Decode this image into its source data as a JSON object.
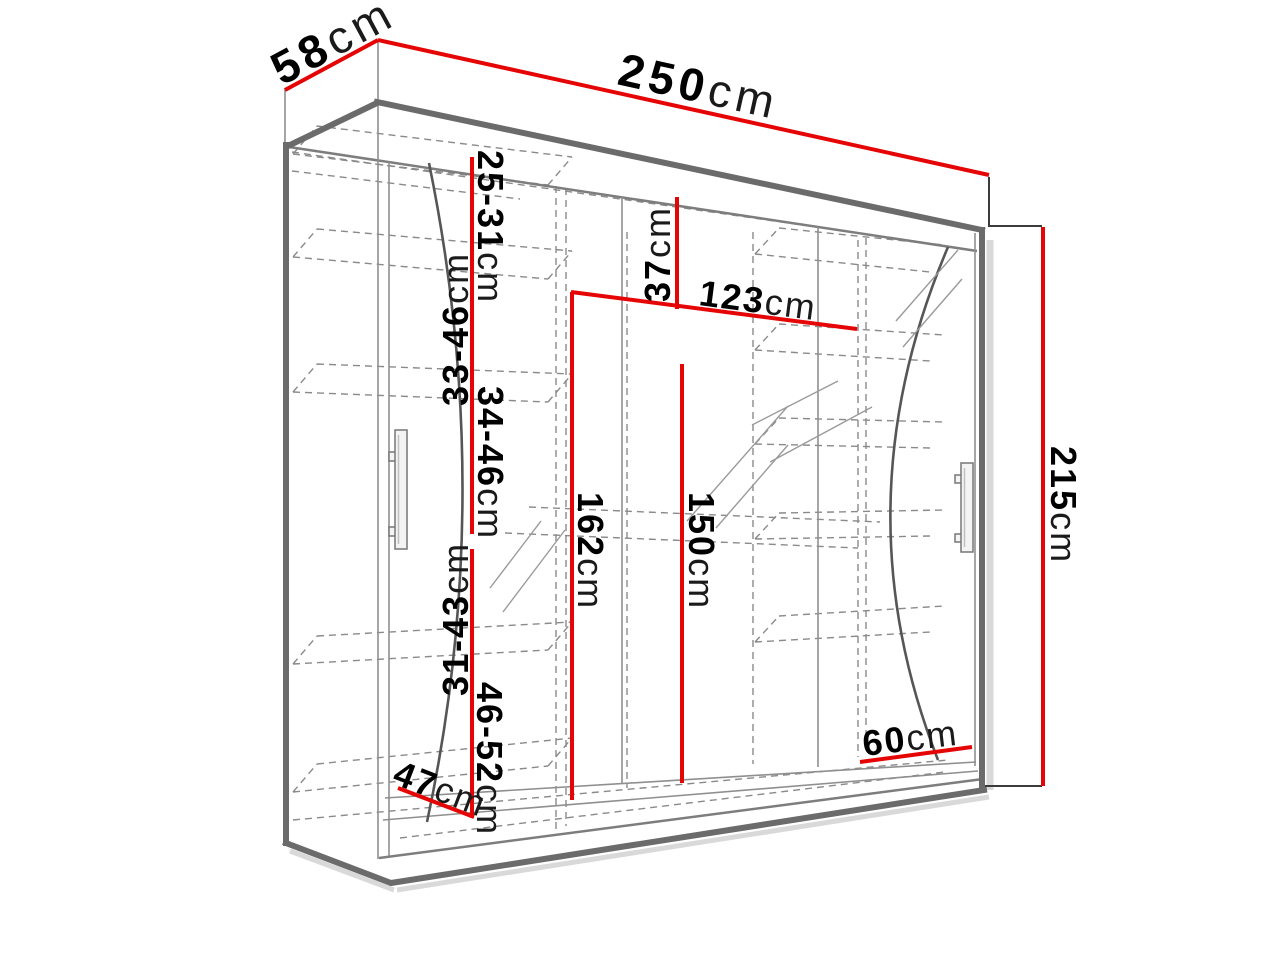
{
  "diagram_type": "wardrobe-dimension-drawing",
  "unit_system": "cm",
  "colors": {
    "dimension_line": "#e60505",
    "outline": "#6b6b6b",
    "line_thin": "#8f8f8f",
    "dashed": "#8a8a8a",
    "label": "#000000",
    "shadow": "#d9d9d9"
  },
  "dimensions": {
    "depth": {
      "value": "58",
      "unit": "cm"
    },
    "width": {
      "value": "250",
      "unit": "cm"
    },
    "height": {
      "value": "215",
      "unit": "cm"
    },
    "shelf_gap_1": {
      "value": "25-31",
      "unit": "cm"
    },
    "shelf_gap_2": {
      "value": "33-46",
      "unit": "cm"
    },
    "shelf_gap_3": {
      "value": "34-46",
      "unit": "cm"
    },
    "shelf_gap_4": {
      "value": "31-43",
      "unit": "cm"
    },
    "shelf_gap_5": {
      "value": "46-52",
      "unit": "cm"
    },
    "top_section_height": {
      "value": "37",
      "unit": "cm"
    },
    "middle_section_width": {
      "value": "123",
      "unit": "cm"
    },
    "hanging_height_left": {
      "value": "162",
      "unit": "cm"
    },
    "hanging_height_right": {
      "value": "150",
      "unit": "cm"
    },
    "bottom_depth": {
      "value": "47",
      "unit": "cm"
    },
    "bottom_shelf_width": {
      "value": "60",
      "unit": "cm"
    }
  }
}
